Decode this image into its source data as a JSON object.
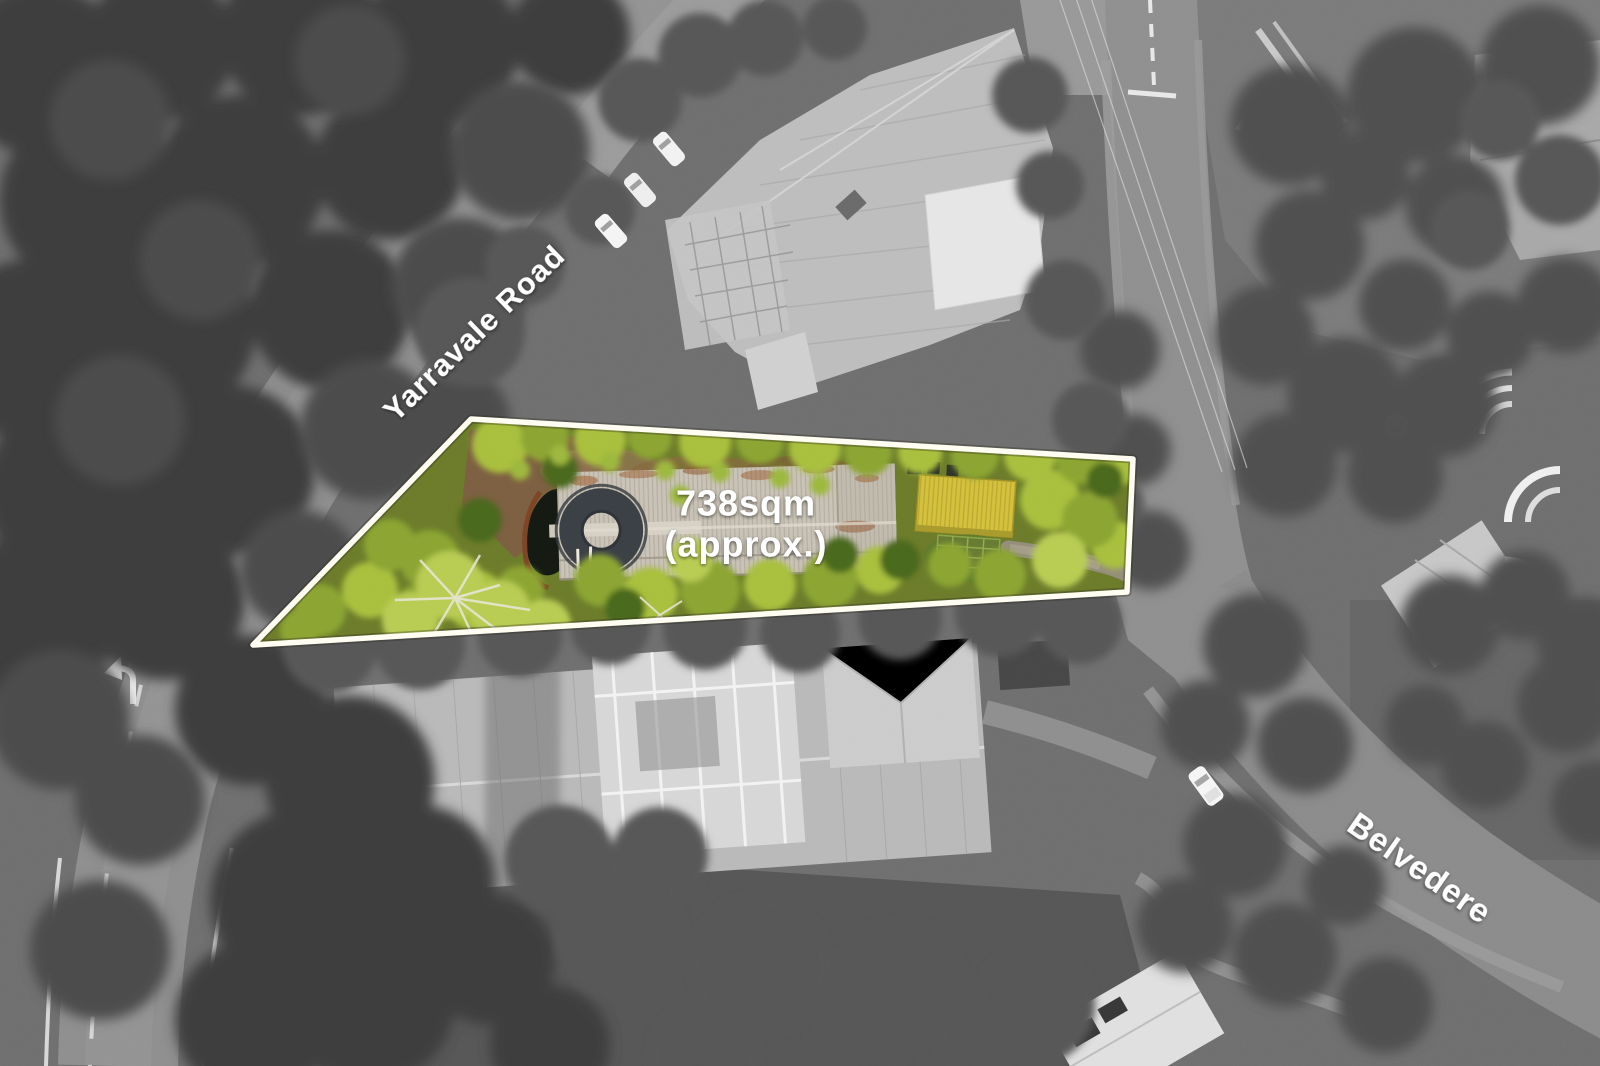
{
  "labels": {
    "road_top_left": "Yarravale Road",
    "road_bottom_right": "Belvedere",
    "area_line1": "738sqm",
    "area_line2": "(approx.)"
  },
  "property": {
    "area_value": "738",
    "area_unit": "sqm",
    "area_qualifier": "approx."
  },
  "colors": {
    "boundary": "#fffdf2",
    "label_text": "#ffffff",
    "lot_green": "#8ba433",
    "lot_green_bright": "#a8bf3e",
    "yellow_roof": "#d4c13d",
    "roof_gray": "#c9c3b7",
    "background_gray": "#6f6f6f"
  }
}
